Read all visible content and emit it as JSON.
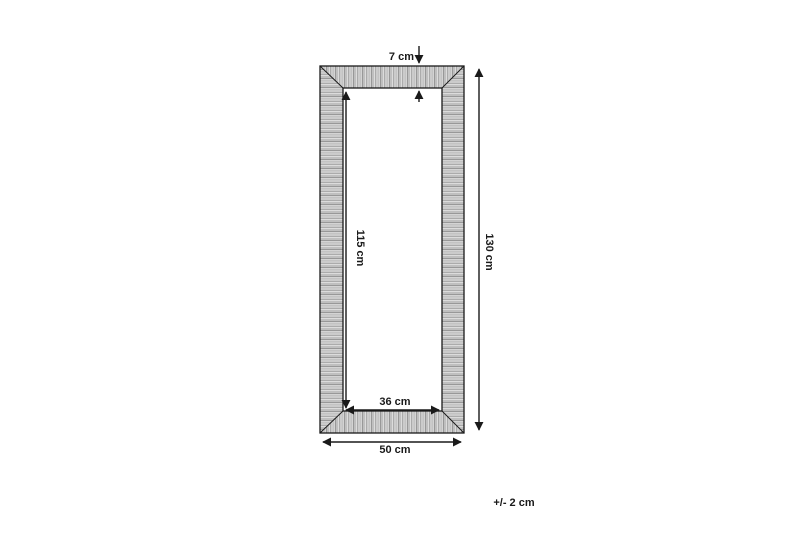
{
  "labels": {
    "frame_thickness": "7 cm",
    "inner_height": "115 cm",
    "outer_height": "130 cm",
    "inner_width": "36 cm",
    "outer_width": "50 cm",
    "tolerance": "+/- 2 cm"
  },
  "colors": {
    "line": "#1a1a1a",
    "text": "#1a1a1a",
    "frame_base": "#c6c6c6",
    "frame_stripe_dark": "#989898",
    "frame_stripe_light": "#dcdcdc",
    "background": "#ffffff"
  }
}
